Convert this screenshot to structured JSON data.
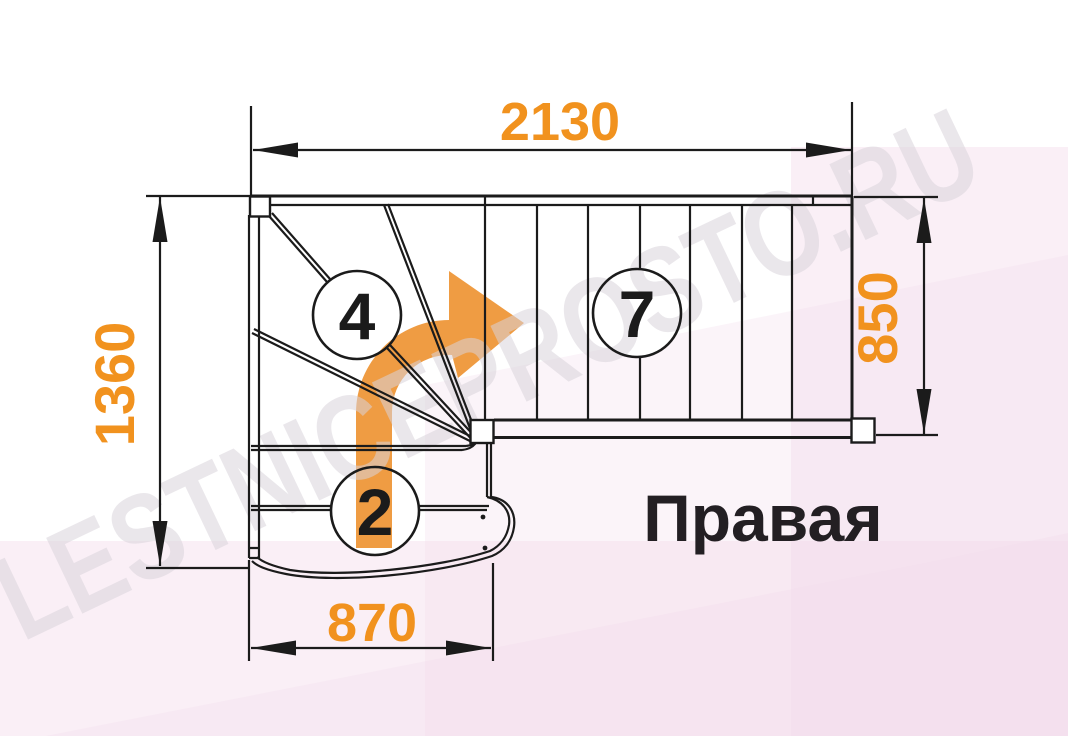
{
  "watermark": {
    "text": "LESTNICEPROSTO.RU"
  },
  "plan": {
    "orientation_label": "Правая",
    "dimensions": {
      "top": "2130",
      "left": "1360",
      "right": "850",
      "bottom": "870"
    },
    "step_markers": {
      "winder": "4",
      "upper_flight": "7",
      "lower_flight": "2"
    }
  },
  "colors": {
    "dimension_text": "#F1921E",
    "direction_arrow": "#EF9C43",
    "linework": "#1B1B1B",
    "watermark_text": "#D8D3DB",
    "background_tint": "#F3DAEA"
  }
}
